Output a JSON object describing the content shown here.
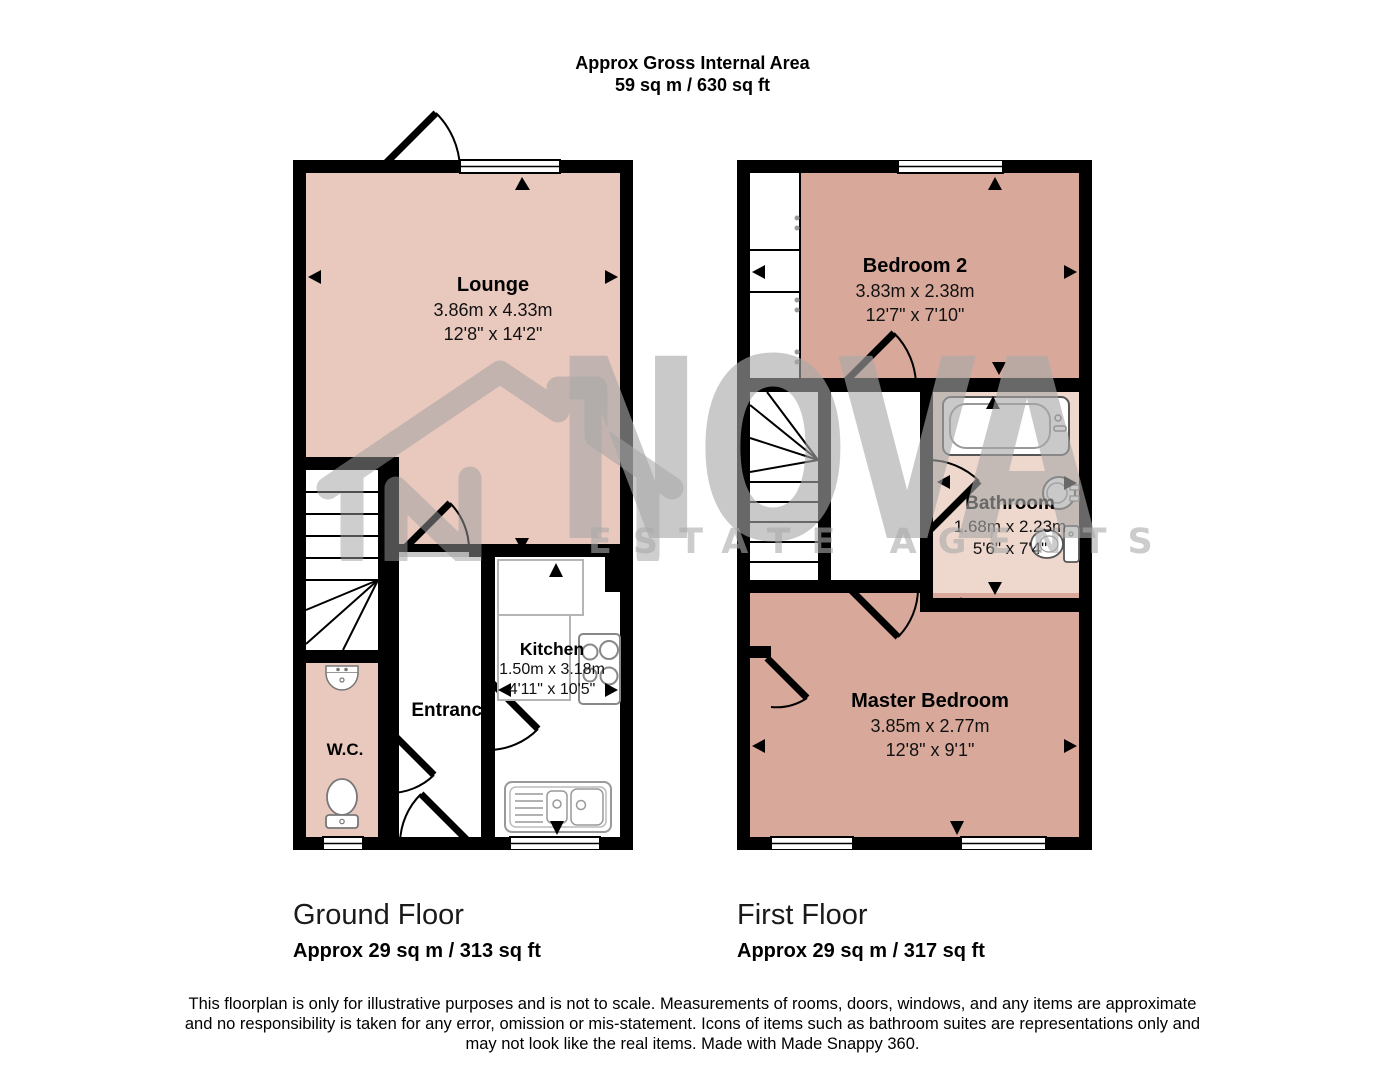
{
  "header": {
    "line1": "Approx Gross Internal Area",
    "line2": "59 sq m / 630 sq ft"
  },
  "watermark": {
    "brand": "NOVA",
    "tagline": "ESTATE AGENTS"
  },
  "ground_floor": {
    "caption": "Ground Floor",
    "area": "Approx 29 sq m / 313 sq ft",
    "rooms": {
      "lounge": {
        "name": "Lounge",
        "metric": "3.86m x 4.33m",
        "imperial": "12'8\" x 14'2\""
      },
      "kitchen": {
        "name": "Kitchen",
        "metric": "1.50m x 3.18m",
        "imperial": "4'11\" x 10'5\""
      },
      "entrance": {
        "name": "Entrance"
      },
      "wc": {
        "name": "W.C."
      }
    }
  },
  "first_floor": {
    "caption": "First Floor",
    "area": "Approx 29 sq m / 317 sq ft",
    "rooms": {
      "bedroom2": {
        "name": "Bedroom 2",
        "metric": "3.83m x 2.38m",
        "imperial": "12'7\" x 7'10\""
      },
      "bathroom": {
        "name": "Bathroom",
        "metric": "1.68m x 2.23m",
        "imperial": "5'6\" x 7'4\""
      },
      "master": {
        "name": "Master Bedroom",
        "metric": "3.85m x 2.77m",
        "imperial": "12'8\" x 9'1\""
      }
    }
  },
  "disclaimer": {
    "lines": [
      "This floorplan is only for illustrative purposes and is not to scale. Measurements of rooms, doors, windows, and any items are approximate",
      "and no responsibility is taken for any error, omission or mis-statement. Icons of items such as bathroom suites are representations only and",
      "may not look like the real items. Made with Made Snappy 360."
    ]
  },
  "colors": {
    "lounge_pink": "#e9c9be",
    "wc_pink": "#e9c9be",
    "bedroom_salmon": "#d8a99a",
    "bathroom_pink": "#eed8cd",
    "wall_black": "#000000",
    "watermark_gray": "#c6c6c6"
  }
}
